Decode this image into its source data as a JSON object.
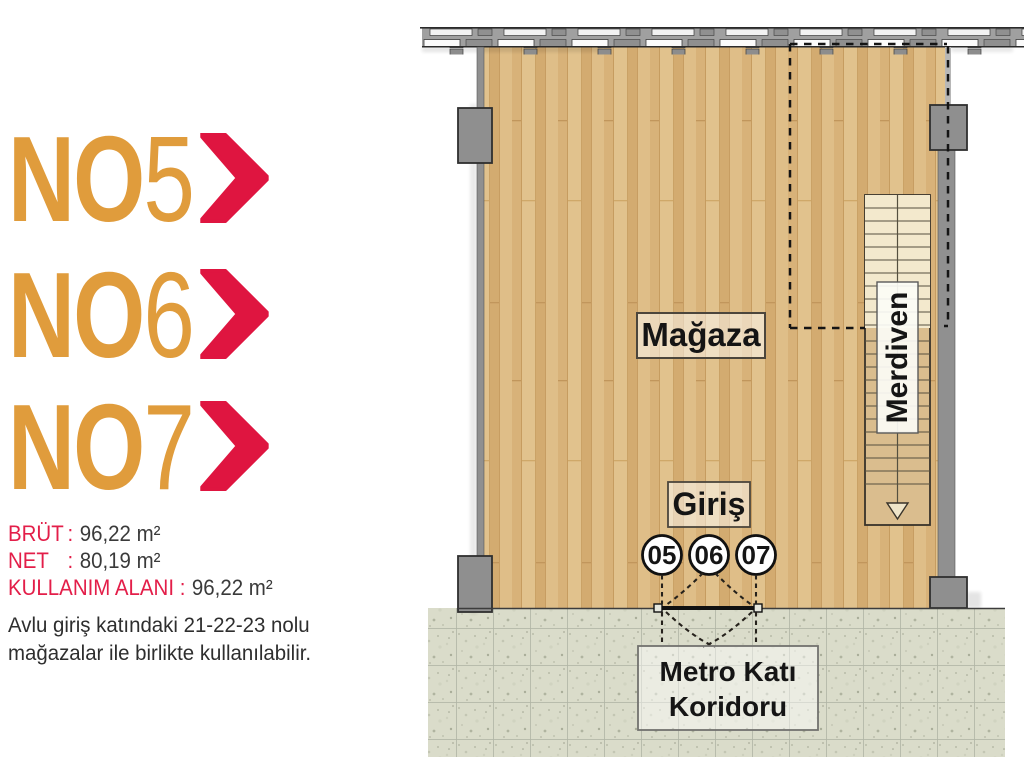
{
  "colors": {
    "orange": "#E09C3C",
    "crimson": "#E31E49",
    "chevron_red": "#DF1540",
    "text_dark": "#3A3A3A",
    "wood_base": "#DCB981",
    "wall_gray": "#8F8F8F",
    "concrete": "#DADCCA"
  },
  "units": [
    {
      "prefix": "NO",
      "number": "5"
    },
    {
      "prefix": "NO",
      "number": "6"
    },
    {
      "prefix": "NO",
      "number": "7"
    }
  ],
  "specs": [
    {
      "label": "BRÜT",
      "separator": ":",
      "value": "96,22 m²"
    },
    {
      "label": "NET",
      "separator": ":",
      "value": "80,19 m²"
    },
    {
      "label": "KULLANIM ALANI",
      "separator": ":",
      "value": "96,22 m²"
    }
  ],
  "note_lines": [
    "Avlu giriş katındaki 21-22-23 nolu",
    "mağazalar ile birlikte kullanılabilir."
  ],
  "plan": {
    "room_label": "Mağaza",
    "entrance_label": "Giriş",
    "stairs_label": "Merdiven",
    "corridor_label_line1": "Metro Katı",
    "corridor_label_line2": "Koridoru",
    "unit_circles": [
      "05",
      "06",
      "07"
    ]
  }
}
